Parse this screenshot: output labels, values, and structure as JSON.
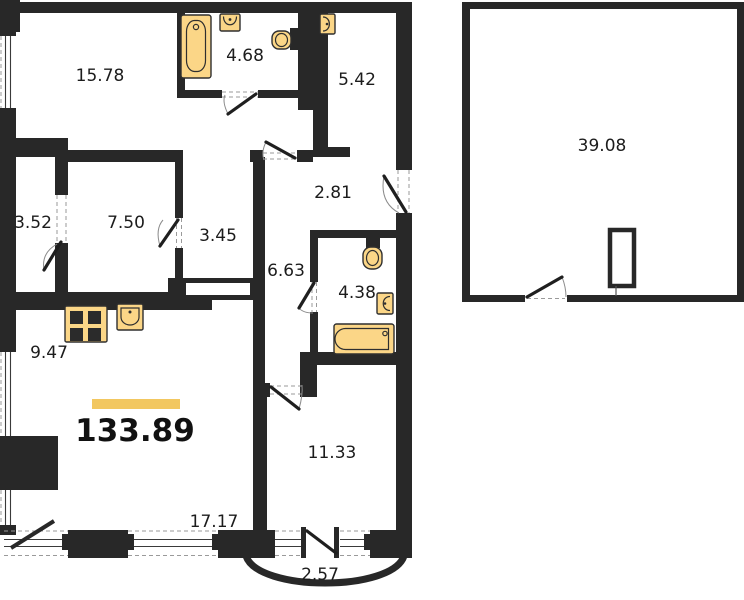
{
  "plan": {
    "areas": {
      "room_top_left": "15.78",
      "bathroom_top": "4.68",
      "room_top_right": "5.42",
      "closet_left": "3.52",
      "room_mid_left": "7.50",
      "corridor_mid": "3.45",
      "hall_upper": "2.81",
      "hall_lower": "6.63",
      "bathroom_mid": "4.38",
      "kitchen": "9.47",
      "living_bottom": "17.17",
      "room_bottom_right": "11.33",
      "balcony": "2.57",
      "annex_room": "39.08",
      "total": "133.89"
    },
    "fixtures": {
      "bathtub_vertical": "bathtub-icon",
      "bathtub_horizontal": "bathtub-icon",
      "sinks": "sink-icon",
      "toilets": "toilet-icon",
      "stove": "stove-icon",
      "column": "column-icon"
    },
    "colors": {
      "wall": "#282828",
      "background": "#ffffff",
      "fixture_fill": "#FBD687",
      "fixture_stroke": "#2f2f2f",
      "accent_bar": "#F2C760",
      "label_text": "#1c1c1c",
      "dashed_lines": "#9a9a9a"
    }
  }
}
